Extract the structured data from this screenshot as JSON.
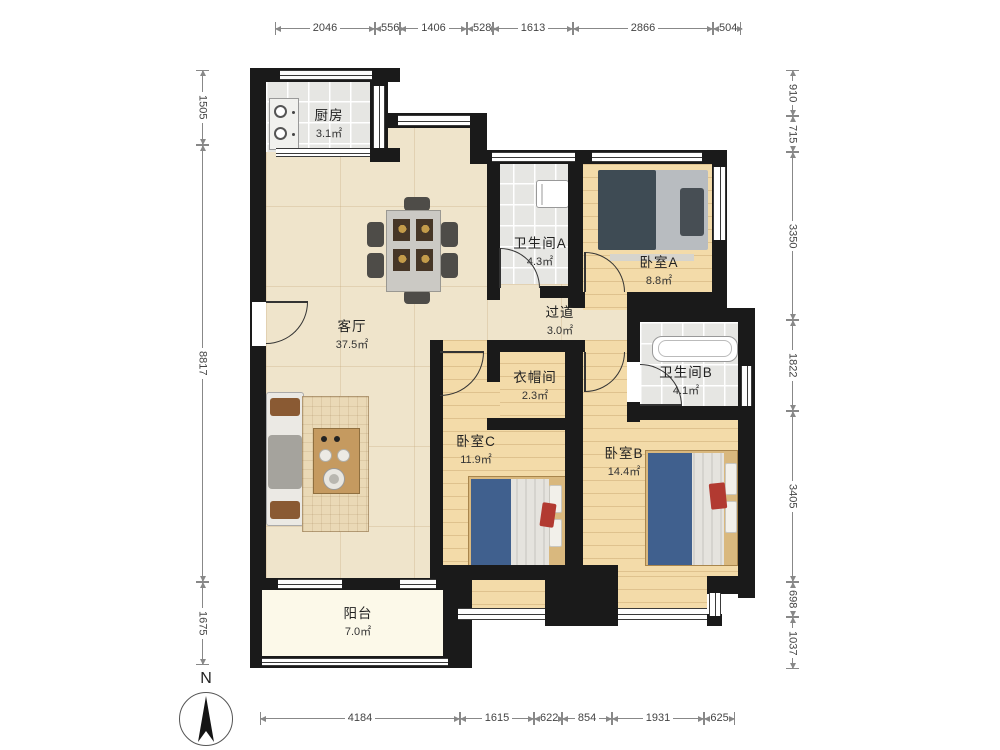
{
  "rooms": [
    {
      "id": "kitchen",
      "name": "厨房",
      "area": "3.1㎡"
    },
    {
      "id": "living",
      "name": "客厅",
      "area": "37.5㎡"
    },
    {
      "id": "bathA",
      "name": "卫生间A",
      "area": "4.3㎡"
    },
    {
      "id": "bedA",
      "name": "卧室A",
      "area": "8.8㎡"
    },
    {
      "id": "hall",
      "name": "过道",
      "area": "3.0㎡"
    },
    {
      "id": "closet",
      "name": "衣帽间",
      "area": "2.3㎡"
    },
    {
      "id": "bathB",
      "name": "卫生间B",
      "area": "4.1㎡"
    },
    {
      "id": "bedC",
      "name": "卧室C",
      "area": "11.9㎡"
    },
    {
      "id": "bedB",
      "name": "卧室B",
      "area": "14.4㎡"
    },
    {
      "id": "balcony",
      "name": "阳台",
      "area": "7.0㎡"
    }
  ],
  "dimensions": {
    "top": [
      "2046",
      "556",
      "1406",
      "528",
      "1613",
      "2866",
      "504"
    ],
    "bottom": [
      "4184",
      "1615",
      "622",
      "854",
      "1931",
      "625"
    ],
    "left": [
      "1505",
      "8817",
      "1675"
    ],
    "right": [
      "910",
      "715",
      "3350",
      "1822",
      "3405",
      "698",
      "1037"
    ]
  },
  "compass": {
    "label": "N"
  },
  "colors": {
    "wall": "#1a1a1a",
    "marble_floor": "#efe4cb",
    "wood_floor": "#f3dba9",
    "tile_floor": "#e6e6e3",
    "balcony_floor": "#fcf9e9",
    "bed_blanket_blue": "#40608e",
    "pillow_red": "#b23a31"
  }
}
